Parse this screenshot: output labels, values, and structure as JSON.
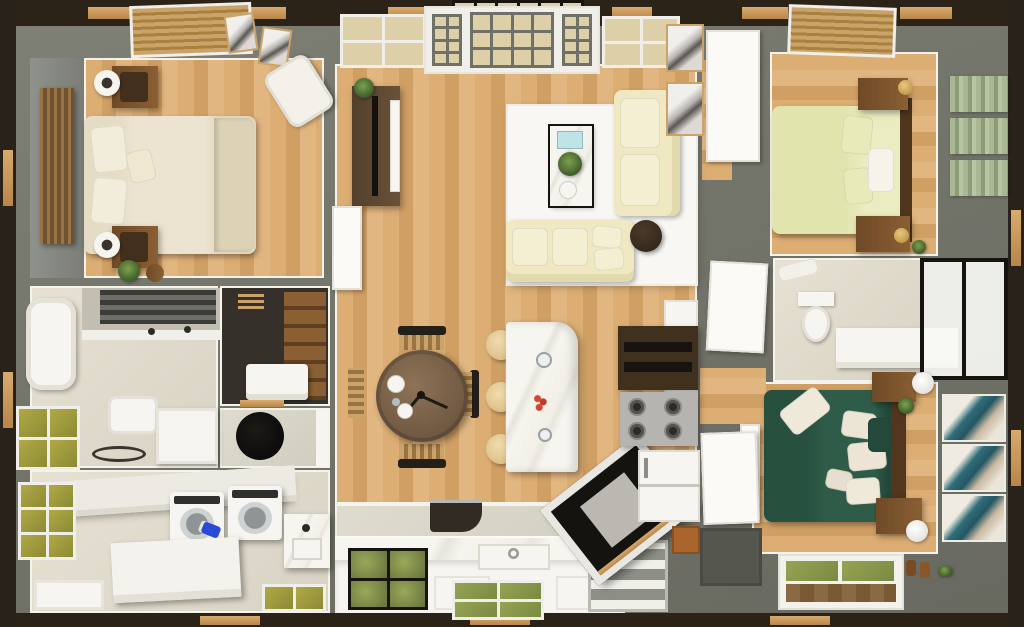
{
  "scene": {
    "type": "3d-floorplan-top-down-render",
    "style": "dollhouse cutaway, single-storey home",
    "palette": {
      "exterior_frame": "#2e2719",
      "frame_trim_tan": "#c89a5e",
      "wall_gray": "#75766c",
      "wood_floor": "#d8a96e",
      "baseboard_white": "#f4f3ec",
      "marble": "#f3f1ea",
      "tile": "#ddd8c9",
      "cream_bed": "#ebe3cf",
      "yellow_bed": "#e9eabd",
      "green_bed": "#2d5a48",
      "sofa_cream": "#f0e9c6",
      "rug_white": "#f8f7f3",
      "walnut": "#7c5531",
      "dark_wood": "#42301d",
      "steel": "#b5b4b0",
      "copper_box": "#a9652c",
      "teal_art": "#2f6d79",
      "green_wall_panel": "#a3b28d",
      "olive_window_glass": "#a89f3e",
      "yard_green_glass": "#8a9a4a",
      "lamp_gold": "#d8b05e",
      "detergent_blue": "#2b4bd7",
      "flower_red": "#c0392b",
      "glass_black_frame": "#17140f"
    },
    "rooms": [
      {
        "id": "bedroom-cream",
        "position": "top-left",
        "furniture": [
          "slat-accent-panel",
          "double-bed-cream",
          "nightstand-top",
          "nightstand-bottom",
          "round-lamp-top",
          "round-lamp-bottom",
          "armchair-white",
          "wall-frames",
          "window-blinds",
          "potted-plant"
        ]
      },
      {
        "id": "living-room",
        "position": "top-center",
        "furniture": [
          "front-door-unit",
          "transom-panes",
          "window-left",
          "window-right",
          "tv-console",
          "tv",
          "area-rug",
          "sofa-vertical",
          "sofa-horizontal",
          "coffee-table-marble",
          "side-table-round",
          "art-frames"
        ]
      },
      {
        "id": "bedroom-yellow",
        "position": "top-right",
        "furniture": [
          "window-blinds",
          "double-bed-yellow",
          "headboard-dark",
          "nightstand-top",
          "nightstand-bottom",
          "gold-lamps",
          "green-striped-wall-panels",
          "door-white"
        ]
      },
      {
        "id": "bathroom-right",
        "position": "middle-right",
        "furniture": [
          "toilet",
          "vanity-counter",
          "glass-shower",
          "door-white",
          "towel"
        ]
      },
      {
        "id": "bedroom-green",
        "position": "bottom-right",
        "furniture": [
          "double-bed-green",
          "pillows-white",
          "headboard-dark",
          "nightstand-top",
          "nightstand-bottom",
          "cylinder-lamps",
          "teal-art-panels",
          "door-white",
          "window-bottom",
          "shoes"
        ]
      },
      {
        "id": "bathroom-left",
        "position": "middle-left",
        "furniture": [
          "bathtub",
          "vanity-with-towels",
          "faucets",
          "toilet",
          "shower-cabinet",
          "window-olive",
          "floor-tray-oval"
        ]
      },
      {
        "id": "walk-in-closet",
        "position": "middle-left-2",
        "furniture": [
          "wood-shelving",
          "dresser-white",
          "vent-grille"
        ]
      },
      {
        "id": "water-closet",
        "position": "middle-left-3",
        "furniture": [
          "round-black-basin"
        ]
      },
      {
        "id": "laundry-room",
        "position": "bottom-left",
        "furniture": [
          "counter-long",
          "washer",
          "dryer",
          "detergent-bottle",
          "island-table",
          "marble-sink-counter",
          "window-olive-left",
          "window-olive-bottom",
          "bench-white"
        ]
      },
      {
        "id": "kitchen",
        "position": "bottom-center",
        "furniture": [
          "marble-counter-run",
          "farmhouse-sink",
          "faucet",
          "window-black-frame",
          "window-yard",
          "cabinet-fronts",
          "range-grates",
          "upper-cabinet-dark",
          "fridge-white",
          "copper-box",
          "stair-hatch-glass",
          "basement-stairs"
        ]
      },
      {
        "id": "dining-area",
        "position": "center",
        "furniture": [
          "round-table-wood",
          "chairs-rattan-4",
          "place-settings"
        ]
      },
      {
        "id": "kitchen-island",
        "position": "center-right",
        "furniture": [
          "island-marble",
          "bar-stools-3",
          "glassware",
          "red-flowers"
        ]
      },
      {
        "id": "hallway",
        "position": "center-vertical",
        "furniture": [
          "doors-white",
          "wood-threshold"
        ]
      }
    ]
  }
}
